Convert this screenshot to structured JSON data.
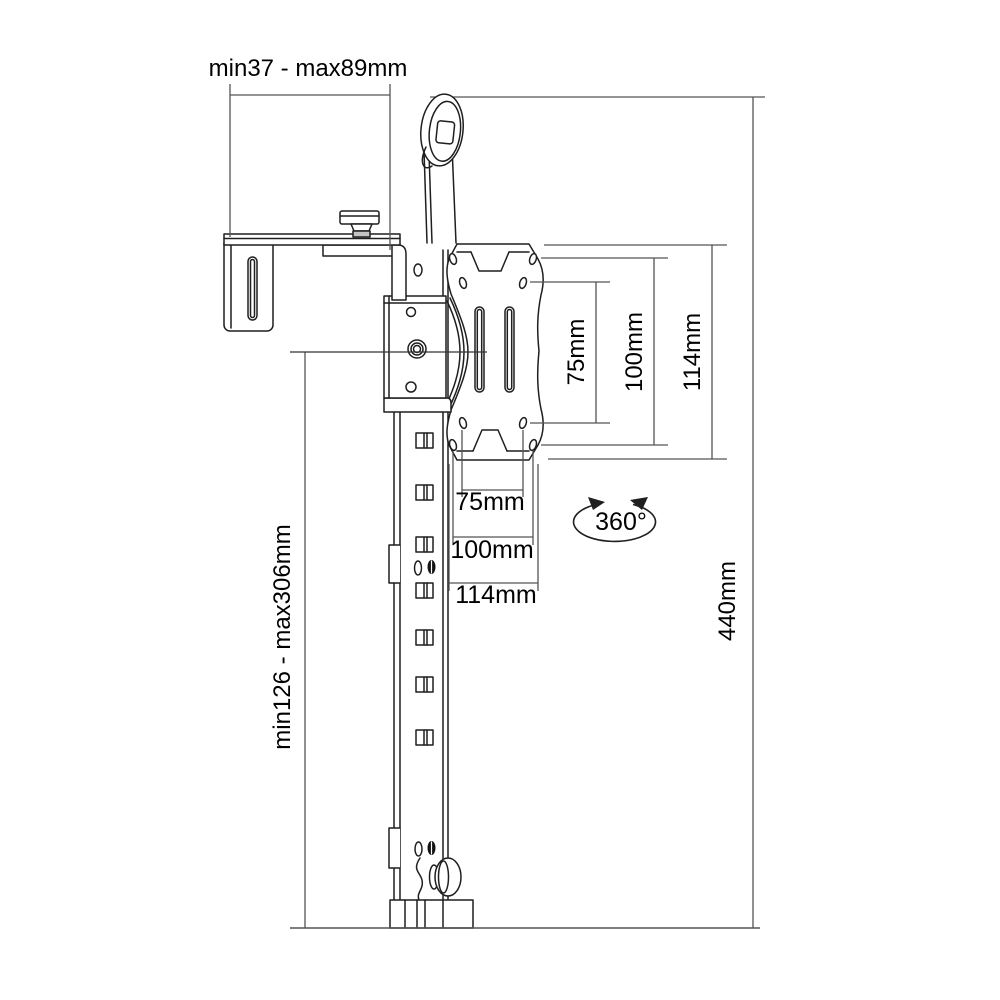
{
  "diagram": {
    "type": "technical-line-drawing",
    "subject": "wall-hook monitor mount with VESA adapter plate, side dimension drawing",
    "labels": {
      "clamp_depth": "min37 - max89mm",
      "vesa_vertical": {
        "v75": "75mm",
        "v100": "100mm",
        "v114": "114mm"
      },
      "vesa_horizontal": {
        "h75": "75mm",
        "h100": "100mm",
        "h114": "114mm"
      },
      "rotation": "360°",
      "height_range": "min126 - max306mm",
      "total_height": "440mm"
    },
    "colors": {
      "background": "#ffffff",
      "part_line": "#1f1f1f",
      "dimension_line": "#555555",
      "text": "#000000"
    }
  }
}
